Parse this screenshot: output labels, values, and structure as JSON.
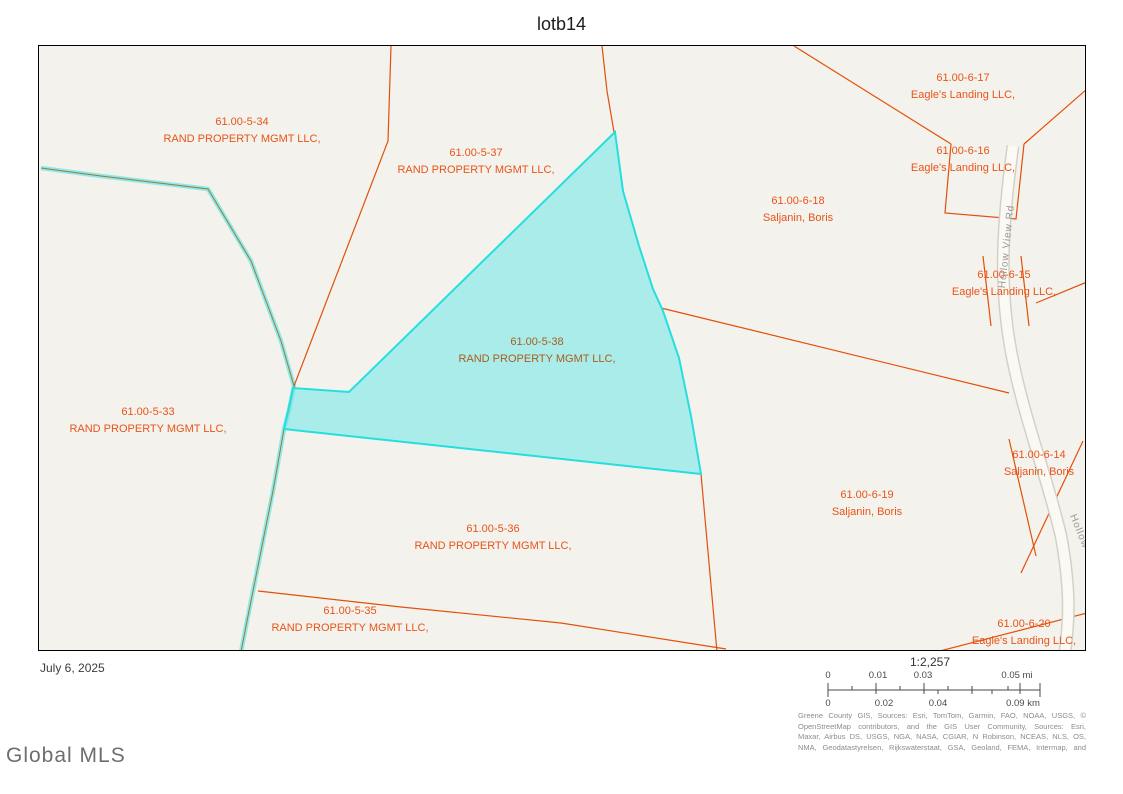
{
  "window": {
    "title": "lotb14"
  },
  "map": {
    "road": {
      "name": "Hollow View Rd",
      "short_label": "Hollow"
    },
    "parcels": [
      {
        "id": "61.00-5-34",
        "owner": "RAND PROPERTY MGMT LLC,",
        "x": 203,
        "y": 68,
        "subject": false
      },
      {
        "id": "61.00-5-37",
        "owner": "RAND PROPERTY MGMT LLC,",
        "x": 437,
        "y": 99,
        "subject": false
      },
      {
        "id": "61.00-5-38",
        "owner": "RAND PROPERTY MGMT LLC,",
        "x": 498,
        "y": 288,
        "subject": true
      },
      {
        "id": "61.00-5-33",
        "owner": "RAND PROPERTY MGMT LLC,",
        "x": 109,
        "y": 358,
        "subject": false
      },
      {
        "id": "61.00-5-36",
        "owner": "RAND PROPERTY MGMT LLC,",
        "x": 454,
        "y": 475,
        "subject": false
      },
      {
        "id": "61.00-5-35",
        "owner": "RAND PROPERTY MGMT LLC,",
        "x": 311,
        "y": 557,
        "subject": false
      },
      {
        "id": "61.00-6-17",
        "owner": "Eagle's Landing LLC,",
        "x": 924,
        "y": 24,
        "subject": false
      },
      {
        "id": "61.00-6-16",
        "owner": "Eagle's Landing LLC,",
        "x": 924,
        "y": 97,
        "subject": false
      },
      {
        "id": "61.00-6-18",
        "owner": "Saljanin, Boris",
        "x": 759,
        "y": 147,
        "subject": false
      },
      {
        "id": "61.00-6-15",
        "owner": "Eagle's Landing LLC,",
        "x": 965,
        "y": 221,
        "subject": false
      },
      {
        "id": "61.00-6-14",
        "owner": "Saljanin, Boris",
        "x": 1000,
        "y": 401,
        "subject": false
      },
      {
        "id": "61.00-6-19",
        "owner": "Saljanin, Boris",
        "x": 828,
        "y": 441,
        "subject": false
      },
      {
        "id": "61.00-6-20",
        "owner": "Eagle's Landing LLC,",
        "x": 985,
        "y": 570,
        "subject": false
      }
    ],
    "colors": {
      "background": "#f4f2ec",
      "parcel_line": "#e2500a",
      "label": "#e8541a",
      "subject_fill": "#7de8e8",
      "subject_border": "#25dede",
      "stream": "#8deaea",
      "road_fill": "#faf9f4"
    }
  },
  "footer": {
    "date": "July 6, 2025",
    "logo": "Global MLS",
    "scalebar": {
      "ratio": "1:2,257",
      "mi_labels": [
        "0",
        "0.01",
        "0.03",
        "0.05 mi"
      ],
      "km_labels": [
        "0",
        "0.02",
        "0.04",
        "0.09 km"
      ]
    },
    "attribution": [
      "Greene County GIS, Sources: Esri, TomTom, Garmin, FAO, NOAA, USGS, ©",
      "OpenStreetMap contributors, and the GIS User Community, Sources: Esri,",
      "Maxar, Airbus DS, USGS, NGA, NASA, CGIAR, N Robinson, NCEAS, NLS, OS,",
      "NMA, Geodatastyrelsen, Rijkswaterstaat, GSA, Geoland, FEMA, Intermap, and"
    ]
  }
}
